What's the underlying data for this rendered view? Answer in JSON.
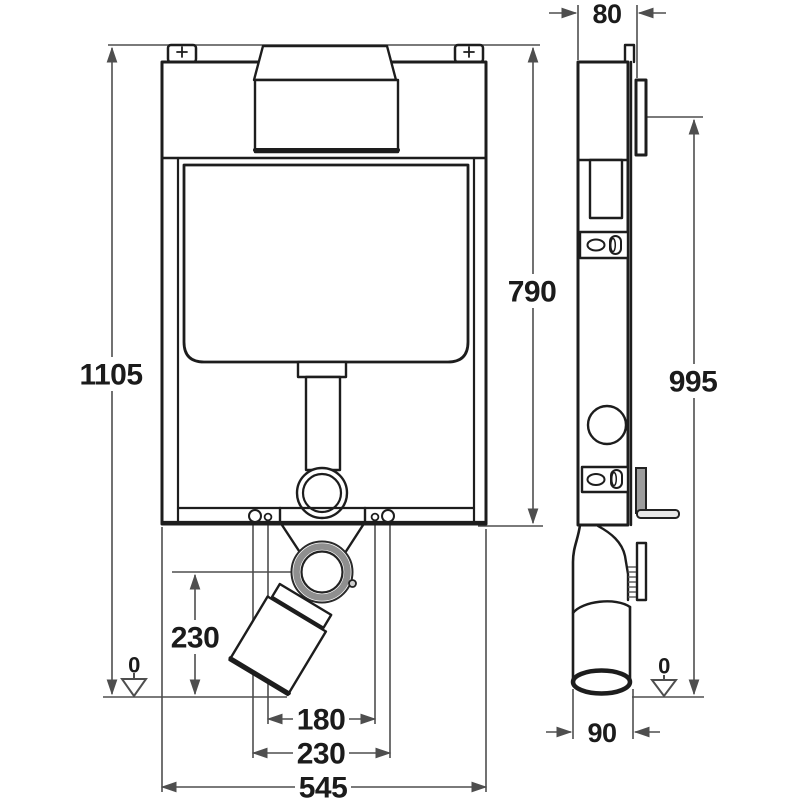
{
  "drawing": {
    "type": "technical-installation-drawing",
    "views": {
      "front": "front-view",
      "side": "side-view"
    },
    "colors": {
      "outline": "#1d1d1d",
      "dimension": "#4e4e4e",
      "background": "#ffffff",
      "gray_fill": "#9c9c9c"
    }
  },
  "dims": {
    "overall_height": "1105",
    "upper_edge_height": "790",
    "outlet_center_height": "230",
    "fixing_bolt_spacing": "180",
    "outlet_connection_spacing": "230",
    "frame_width": "545",
    "frame_depth": "80",
    "actuation_height": "995",
    "outlet_pipe_diameter": "90",
    "floor_level_left": "0",
    "floor_level_right": "0"
  }
}
